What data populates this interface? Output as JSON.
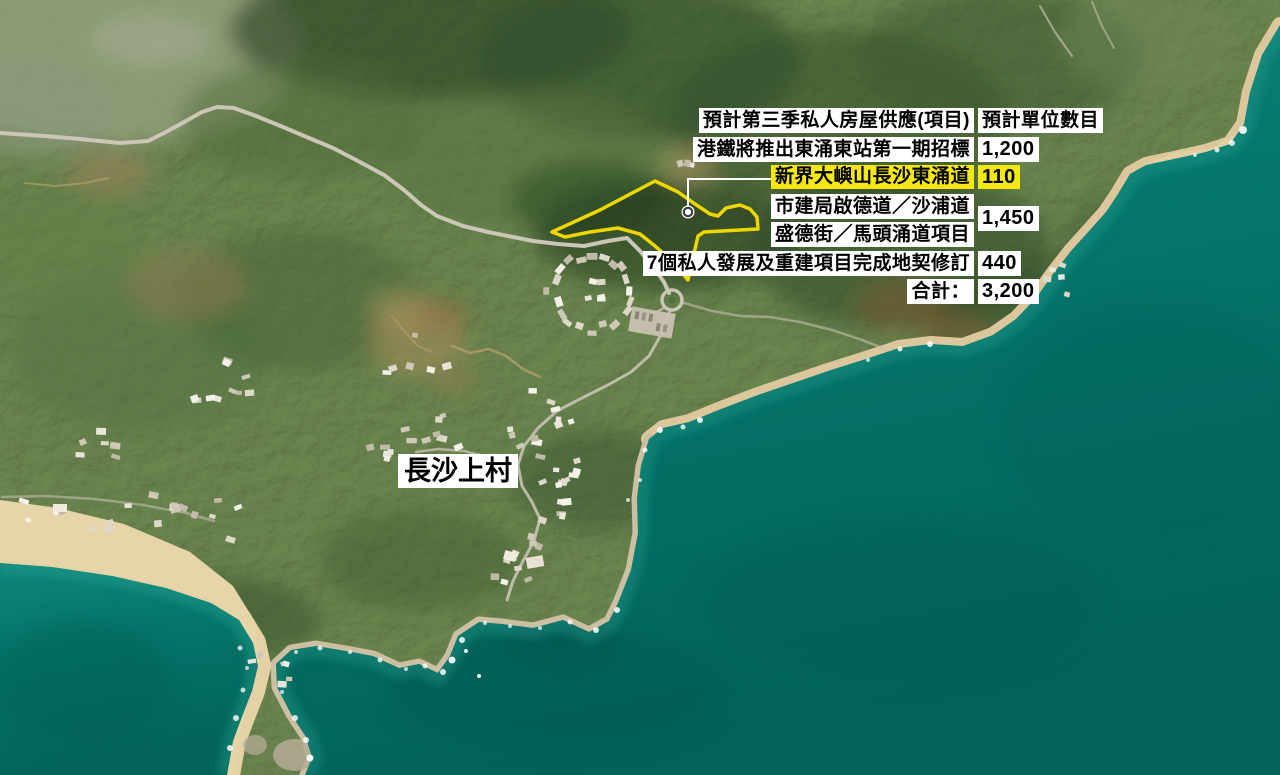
{
  "supply_table": {
    "header": {
      "project_col": "預計第三季私人房屋供應(項目)",
      "units_col": "預計單位數目"
    },
    "rows": [
      {
        "label": "港鐵將推出東涌東站第一期招標",
        "units": "1,200",
        "highlighted": false
      },
      {
        "label": "新界大嶼山長沙東涌道",
        "units": "110",
        "highlighted": true
      },
      {
        "label": "市建局啟德道／沙浦道",
        "highlighted": false
      },
      {
        "label": "盛德街／馬頭涌道項目",
        "highlighted": false
      },
      {
        "label": "7個私人發展及重建項目完成地契修訂",
        "units": "440",
        "highlighted": false
      },
      {
        "label": "合計：",
        "units": "3,200",
        "highlighted": false
      }
    ],
    "merged_units": "1,450"
  },
  "map": {
    "village_label": "長沙上村",
    "site_marker": "新界大嶼山長沙東涌道"
  },
  "colors": {
    "highlight": "#f5e711",
    "site_outline": "#eed600",
    "leader_line": "#ffffff",
    "ocean_deep": "#02635a",
    "ocean_mid": "#0b8478",
    "sand": "#e0cba0"
  }
}
